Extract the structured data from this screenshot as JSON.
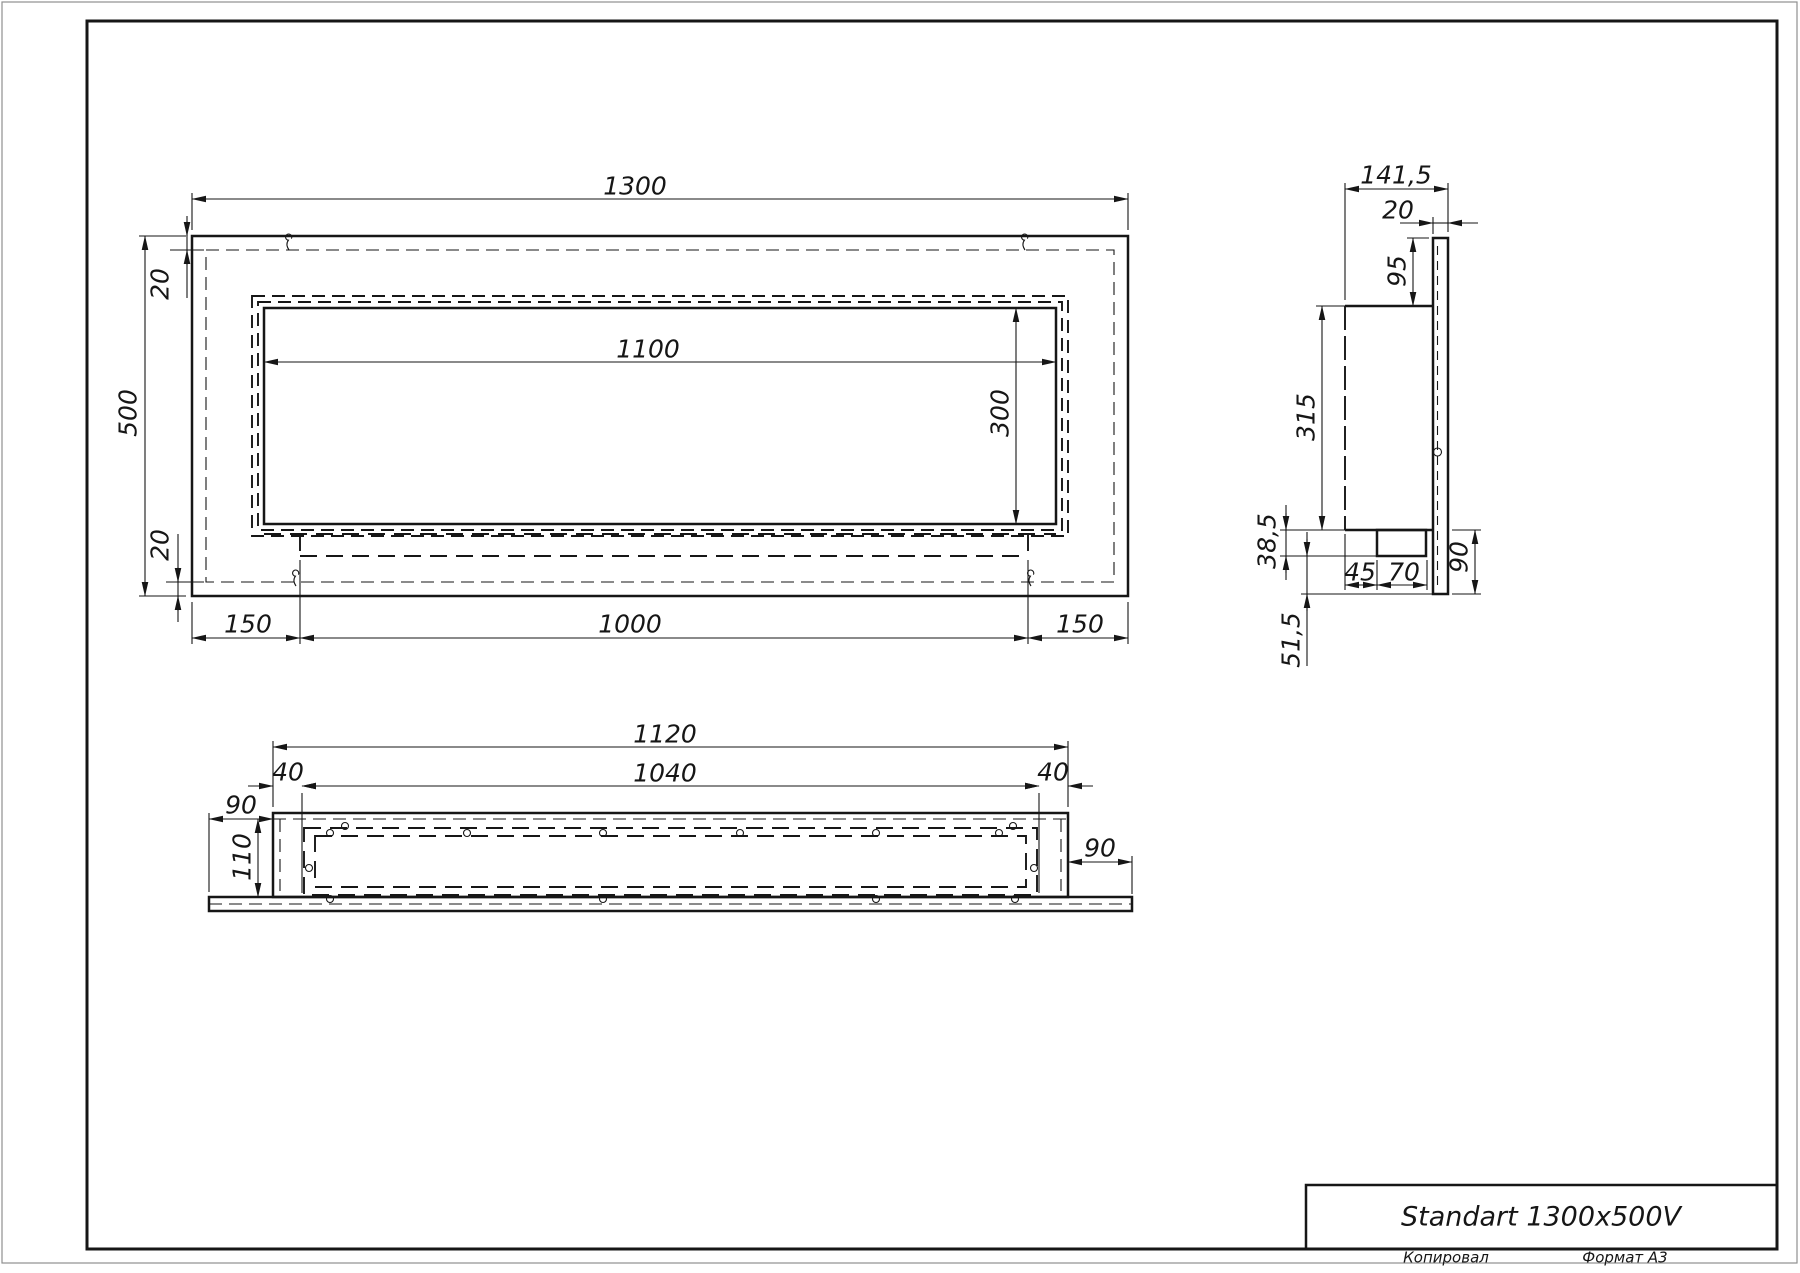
{
  "title_block": {
    "title": "Standart 1300x500V"
  },
  "footer": {
    "copied_label": "Копировал",
    "format_label": "Формат А3"
  },
  "front_view": {
    "dims": {
      "overall_width": "1300",
      "overall_height": "500",
      "top_inset": "20",
      "bottom_inset": "20",
      "opening_width": "1100",
      "opening_height": "300",
      "left_margin": "150",
      "firebox_width": "1000",
      "right_margin": "150"
    }
  },
  "side_view": {
    "dims": {
      "overall_depth": "141,5",
      "panel_thickness": "20",
      "top_offset": "95",
      "body_height": "315",
      "tray_height": "38,5",
      "lower_offset": "51,5",
      "tray_setback": "45",
      "tray_depth": "70",
      "panel_overhang": "90"
    }
  },
  "bottom_view": {
    "dims": {
      "body_width": "1120",
      "inner_width": "1040",
      "left_inset": "40",
      "right_inset": "40",
      "left_flange": "90",
      "body_depth": "110",
      "right_flange": "90"
    }
  },
  "colors": {
    "line": "#161616",
    "background": "#ffffff"
  }
}
